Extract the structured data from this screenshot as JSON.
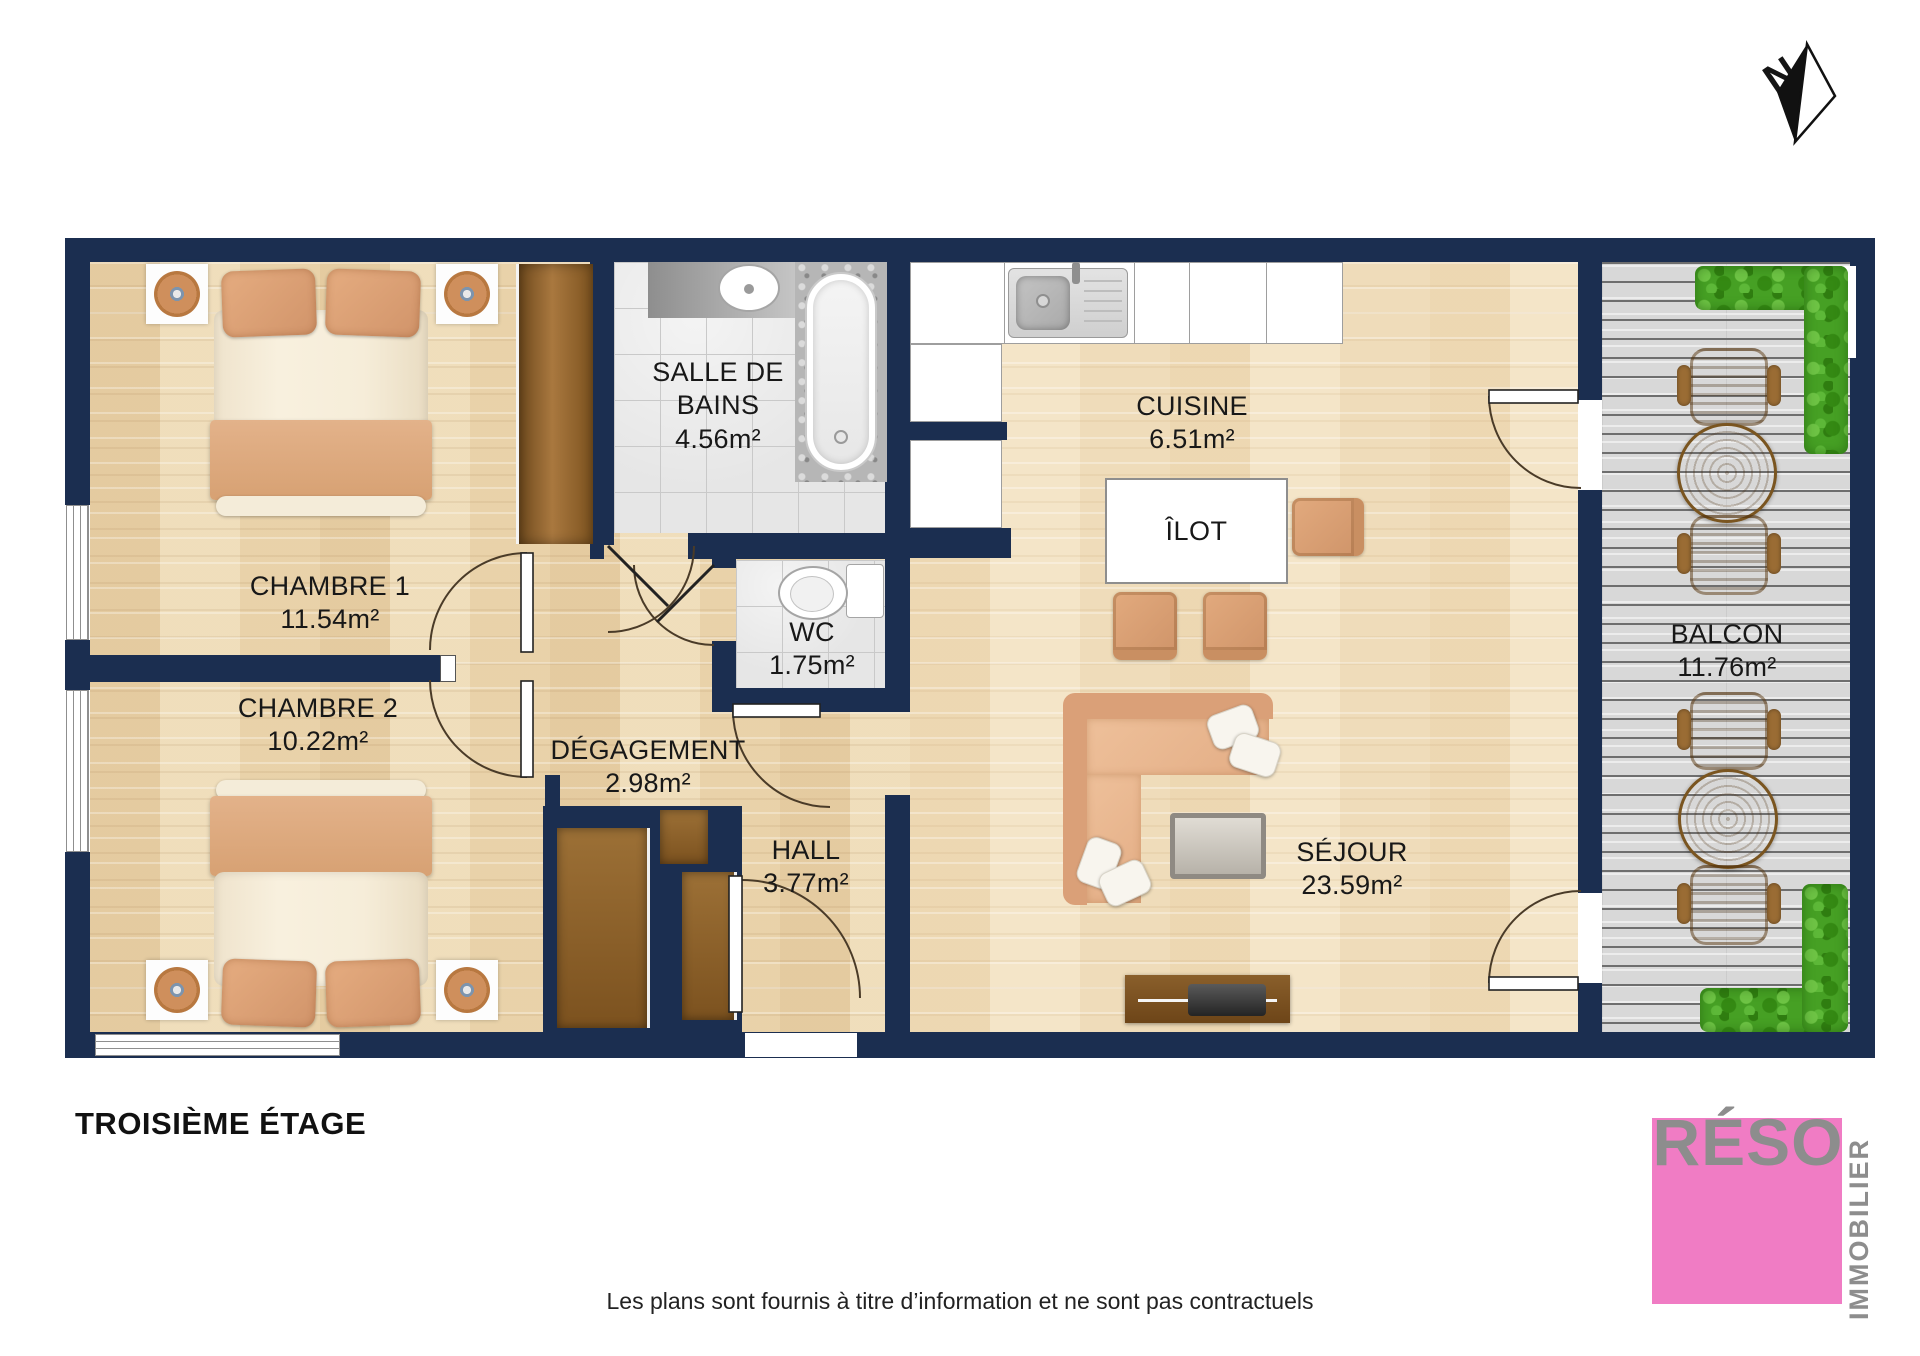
{
  "plan": {
    "title": "TROISIÈME ÉTAGE",
    "disclaimer": "Les plans sont fournis à titre d’information et ne sont pas contractuels",
    "compass_label": "N"
  },
  "rooms": [
    {
      "name": "CHAMBRE 1",
      "area": "11.54m²"
    },
    {
      "name": "CHAMBRE 2",
      "area": "10.22m²"
    },
    {
      "name": "SALLE DE BAINS",
      "area": "4.56m²"
    },
    {
      "name": "WC",
      "area": "1.75m²"
    },
    {
      "name": "DÉGAGEMENT",
      "area": "2.98m²"
    },
    {
      "name": "HALL",
      "area": "3.77m²"
    },
    {
      "name": "CUISINE",
      "area": "6.51m²"
    },
    {
      "name": "ÎLOT",
      "area": ""
    },
    {
      "name": "SÉJOUR",
      "area": "23.59m²"
    },
    {
      "name": "BALCON",
      "area": "11.76m²"
    }
  ],
  "logo": {
    "brand": "RÉSO",
    "tagline": "IMMOBILIER"
  },
  "colors": {
    "wall": "#1b2e50",
    "wood_floor": "#ead6b1",
    "living_floor": "#f0dfc0",
    "tile": "#e6e6e6",
    "deck": "#d8d8d8",
    "furniture_tan": "#dfa87c",
    "closet_brown": "#8a5e2a",
    "rattan": "#a9763f",
    "plant_green": "#46a024",
    "logo_pink": "#f07cc4",
    "logo_gray": "#8d8d8d"
  }
}
